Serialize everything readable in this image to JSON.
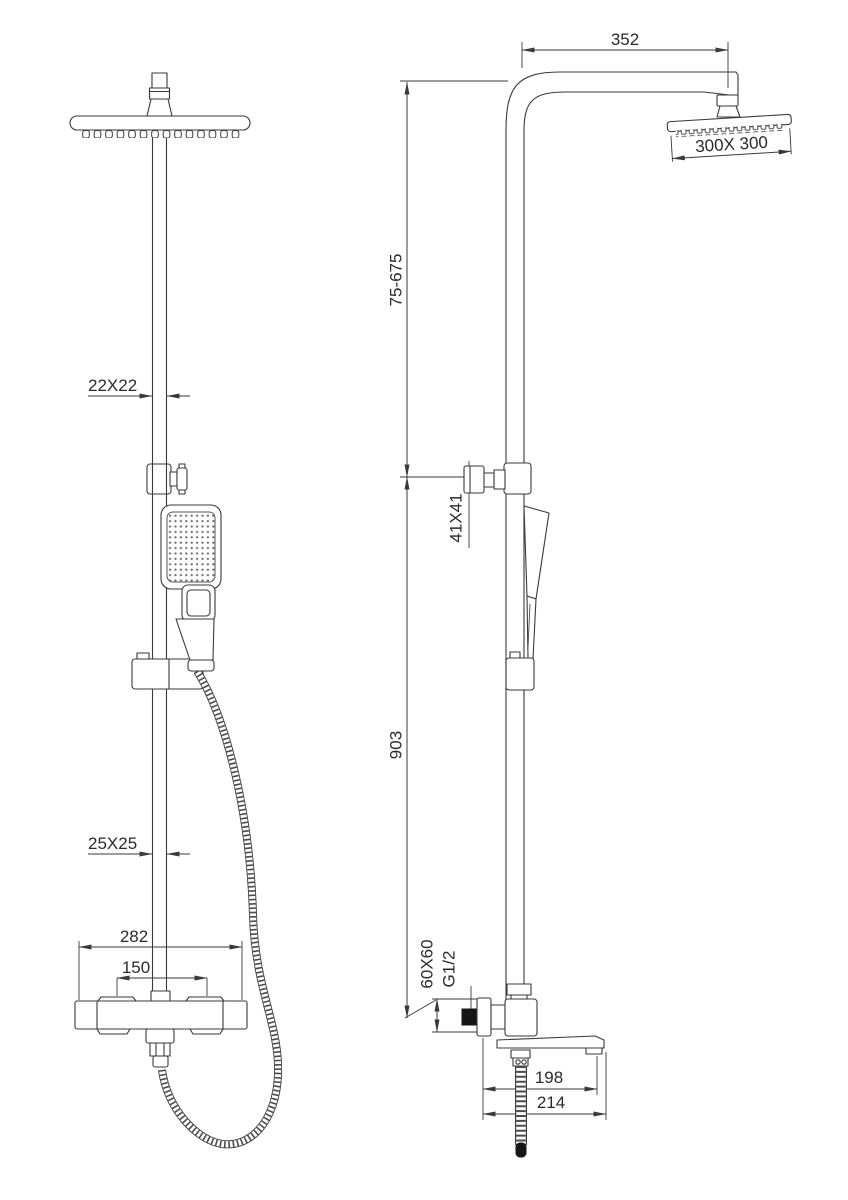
{
  "meta": {
    "title": "Shower column two-view dimensional drawing",
    "drawing_type": "technical line drawing, front and side elevations",
    "units": "mm",
    "background_color": "#ffffff",
    "line_color": "#3a3a3a"
  },
  "views": {
    "front": {
      "name": "front elevation",
      "dims": {
        "upper_pipe_section": "22X22",
        "lower_pipe_section": "25X25",
        "mixer_width": "282",
        "inlet_spacing": "150"
      }
    },
    "side": {
      "name": "side elevation",
      "dims": {
        "arm_reach": "352",
        "head_size": "300X 300",
        "upper_riser_range": "75-675",
        "slider_bracket": "41X41",
        "lower_riser": "903",
        "escutcheon": "60X60",
        "thread": "G1/2",
        "spout_outlet_reach": "198",
        "spout_tip_reach": "214"
      }
    }
  }
}
